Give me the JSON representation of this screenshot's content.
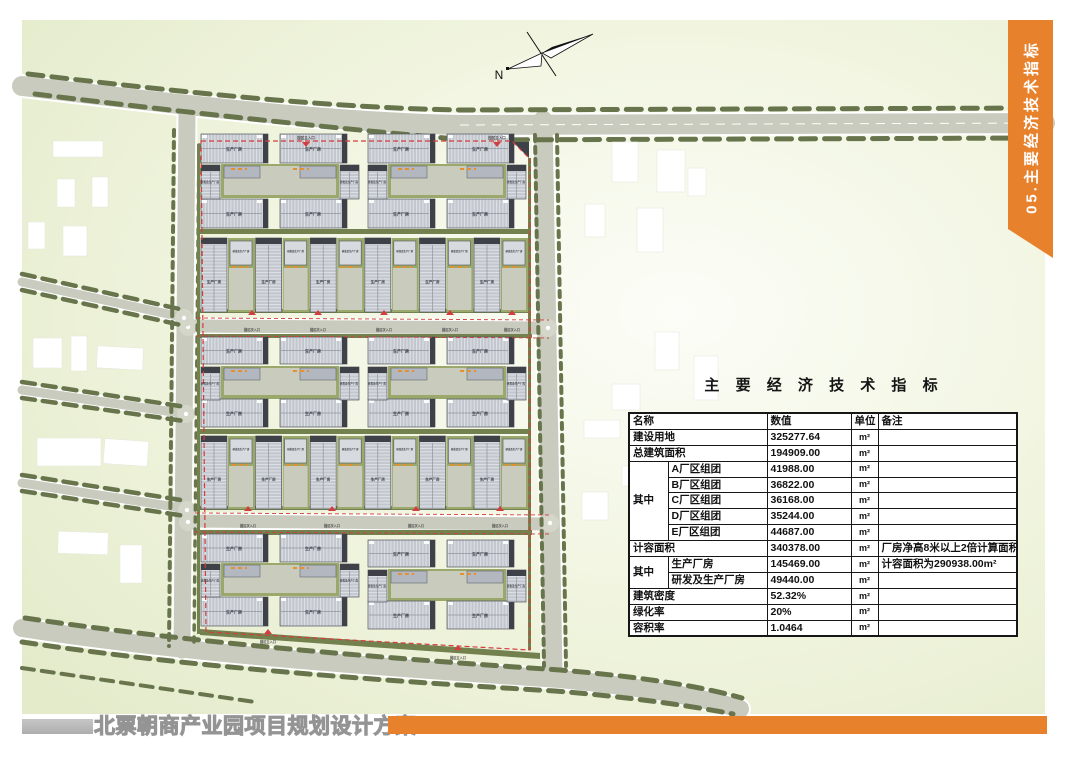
{
  "ribbon": {
    "label": "05.主要经济技术指标",
    "bg": "#E8812C",
    "fg": "#FFFFFF"
  },
  "plan": {
    "north_label": "N",
    "labels": {
      "production": "生产厂房",
      "rd_production": "研发及生产厂房",
      "main_entrance": "园区主入口",
      "secondary_entrance": "园区次入口"
    },
    "colors": {
      "road": "#C8CBBD",
      "tree": "#68754C",
      "hedge": "#72814D",
      "grass": "#9AA96B",
      "building": "#C2C6CD",
      "building_dark": "#3E4248",
      "paving": "#C9CBBC",
      "boundary_red": "#D23D3D",
      "marking_orange": "#E6912F",
      "offsite_building": "#FFFFFF"
    }
  },
  "indicators": {
    "title": "主 要 经 济 技 术 指 标",
    "columns": [
      "名称",
      "数值",
      "单位",
      "备注"
    ],
    "rows": [
      {
        "name": "建设用地",
        "value": "325277.64",
        "unit": "m²",
        "remark": "",
        "full": true
      },
      {
        "name": "总建筑面积",
        "value": "194909.00",
        "unit": "m²",
        "remark": "",
        "full": true
      },
      {
        "group": "其中",
        "group_span": 5,
        "name": "A厂区组团",
        "value": "41988.00",
        "unit": "m²",
        "remark": ""
      },
      {
        "in_group": true,
        "name": "B厂区组团",
        "value": "36822.00",
        "unit": "m²",
        "remark": ""
      },
      {
        "in_group": true,
        "name": "C厂区组团",
        "value": "36168.00",
        "unit": "m²",
        "remark": ""
      },
      {
        "in_group": true,
        "name": "D厂区组团",
        "value": "35244.00",
        "unit": "m²",
        "remark": ""
      },
      {
        "in_group": true,
        "name": "E厂区组团",
        "value": "44687.00",
        "unit": "m²",
        "remark": ""
      },
      {
        "name": "计容面积",
        "value": "340378.00",
        "unit": "m²",
        "remark": "厂房净高8米以上2倍计算面积",
        "full": true
      },
      {
        "group": "其中",
        "group_span": 2,
        "name": "生产厂房",
        "value": "145469.00",
        "unit": "m²",
        "remark": "计容面积为290938.00m²"
      },
      {
        "in_group": true,
        "name": "研发及生产厂房",
        "value": "49440.00",
        "unit": "m²",
        "remark": ""
      },
      {
        "name": "建筑密度",
        "value": "52.32%",
        "unit": "m²",
        "remark": "",
        "full": true
      },
      {
        "name": "绿化率",
        "value": "20%",
        "unit": "m²",
        "remark": "",
        "full": true
      },
      {
        "name": "容积率",
        "value": "1.0464",
        "unit": "m²",
        "remark": "",
        "full": true
      }
    ]
  },
  "footer": {
    "title": "北票朝商产业园项目规划设计方案",
    "orange": "#E8812C",
    "grey": "#B7B7B7"
  }
}
